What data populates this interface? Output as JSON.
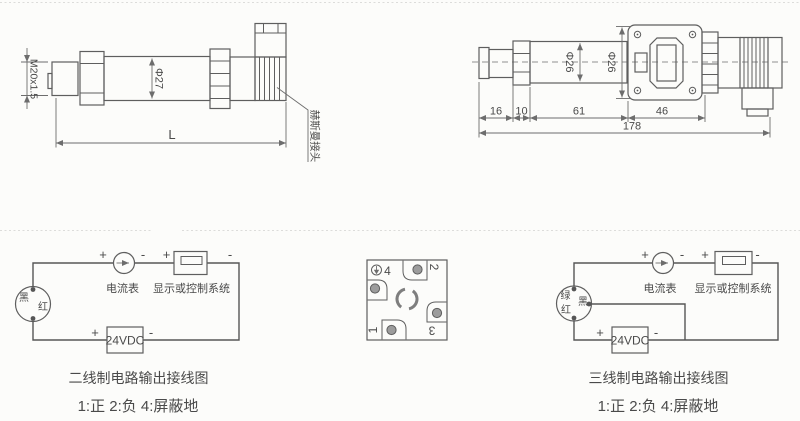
{
  "colors": {
    "background": "#fcfcfa",
    "line": "#5e5e5e",
    "dim_line": "#6d6d6d",
    "wire": "#565656",
    "text": "#4a4a4a",
    "pin_fill": "#9c9c9c",
    "divider": "#dcdcda"
  },
  "side_view_drawing": {
    "thread_dim": "M20x1.5",
    "diameter_dim": "Φ27",
    "length_dim": "L",
    "connector_callout": "赫斯曼接头"
  },
  "front_view_drawing": {
    "body_diameter_dim": "Φ26",
    "housing_diameter_dim": "Φ26",
    "thread_length_dim": "16",
    "hex_length_dim": "10",
    "body_length_dim": "61",
    "housing_length_dim": "46",
    "total_length_dim": "178"
  },
  "two_wire_diagram": {
    "black_wire_label": "黑",
    "red_wire_label": "红",
    "ammeter_label": "电流表",
    "display_label": "显示或控制系统",
    "power_label": "24VDC",
    "plus": "+",
    "minus": "-",
    "caption": "二线制电路输出接线图",
    "pin_note": "1:正 2:负 4:屏蔽地"
  },
  "connector_pinout": {
    "pin_1": "1",
    "pin_2": "2",
    "pin_3": "3",
    "pin_4": "4"
  },
  "three_wire_diagram": {
    "green_wire_label": "绿",
    "black_wire_label": "黑",
    "red_wire_label": "红",
    "ammeter_label": "电流表",
    "display_label": "显示或控制系统",
    "power_label": "24VDC",
    "plus": "+",
    "minus": "-",
    "caption": "三线制电路输出接线图",
    "pin_note": "1:正 2:负 4:屏蔽地"
  }
}
